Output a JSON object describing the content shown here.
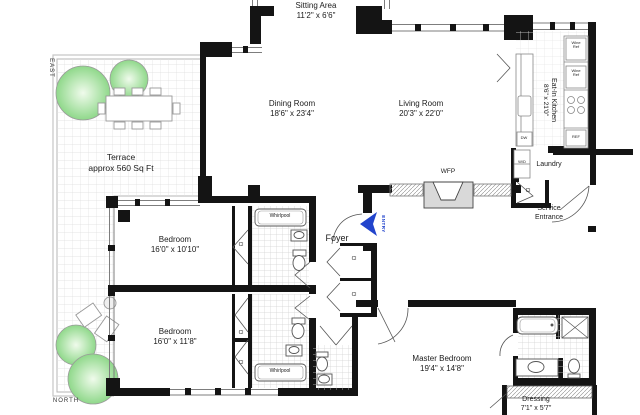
{
  "plan": {
    "compass": {
      "east": "EAST",
      "north": "NORTH"
    },
    "entry": {
      "label": "ENTRY"
    },
    "rooms": {
      "sitting": {
        "name": "Sitting Area",
        "dims": "11'2\" x 6'6\""
      },
      "dining": {
        "name": "Dining Room",
        "dims": "18'6\" x 23'4\""
      },
      "living": {
        "name": "Living Room",
        "dims": "20'3\" x 22'0\""
      },
      "kitchen": {
        "name": "Eat-In Kitchen",
        "dims": "8'6\" x 21'0\""
      },
      "terrace": {
        "name": "Terrace",
        "dims": "approx 560 Sq Ft"
      },
      "bedroom1": {
        "name": "Bedroom",
        "dims": "16'0\" x 10'10\""
      },
      "bedroom2": {
        "name": "Bedroom",
        "dims": "16'0\" x 11'8\""
      },
      "master": {
        "name": "Master Bedroom",
        "dims": "19'4\" x 14'8\""
      },
      "dressing": {
        "name": "Dressing",
        "dims": "7'1\" x 5'7\""
      },
      "foyer": {
        "name": "Foyer"
      },
      "laundry": {
        "name": "Laundry"
      },
      "service": {
        "line1": "Service",
        "line2": "Entrance"
      }
    },
    "fixtures": {
      "wfp": "WFP",
      "whirlpool": "Whirlpool",
      "closet": "Cl",
      "wine_line1": "Wine",
      "wine_line2": "Ref",
      "ref": "REF",
      "dw": "DW",
      "wd": "W/D"
    },
    "colors": {
      "wall": "#141414",
      "entry_arrow": "#2244cc",
      "tree": "#9bdb92",
      "fireplace": "#d9d9d9"
    }
  }
}
